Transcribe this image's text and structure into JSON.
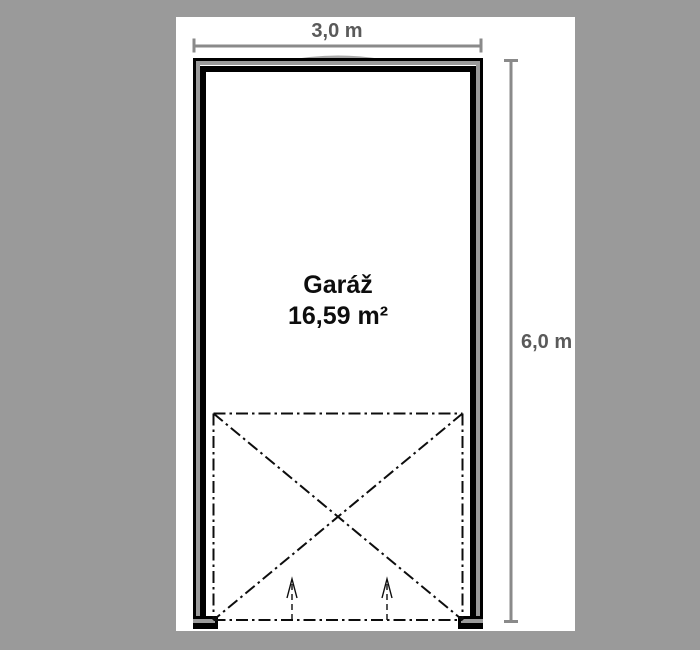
{
  "drawing": {
    "room_name": "Garáž",
    "room_area": "16,59 m²",
    "width_dimension": "3,0 m",
    "height_dimension": "6,0 m"
  },
  "colors": {
    "background": "#9a9a9a",
    "paper": "#ffffff",
    "wall_line": "#000000",
    "wall_core": "#9a9a9a",
    "dimension_line": "#8a8a8a",
    "dimension_text": "#5a5a5a",
    "room_text": "#0d0d0d"
  }
}
